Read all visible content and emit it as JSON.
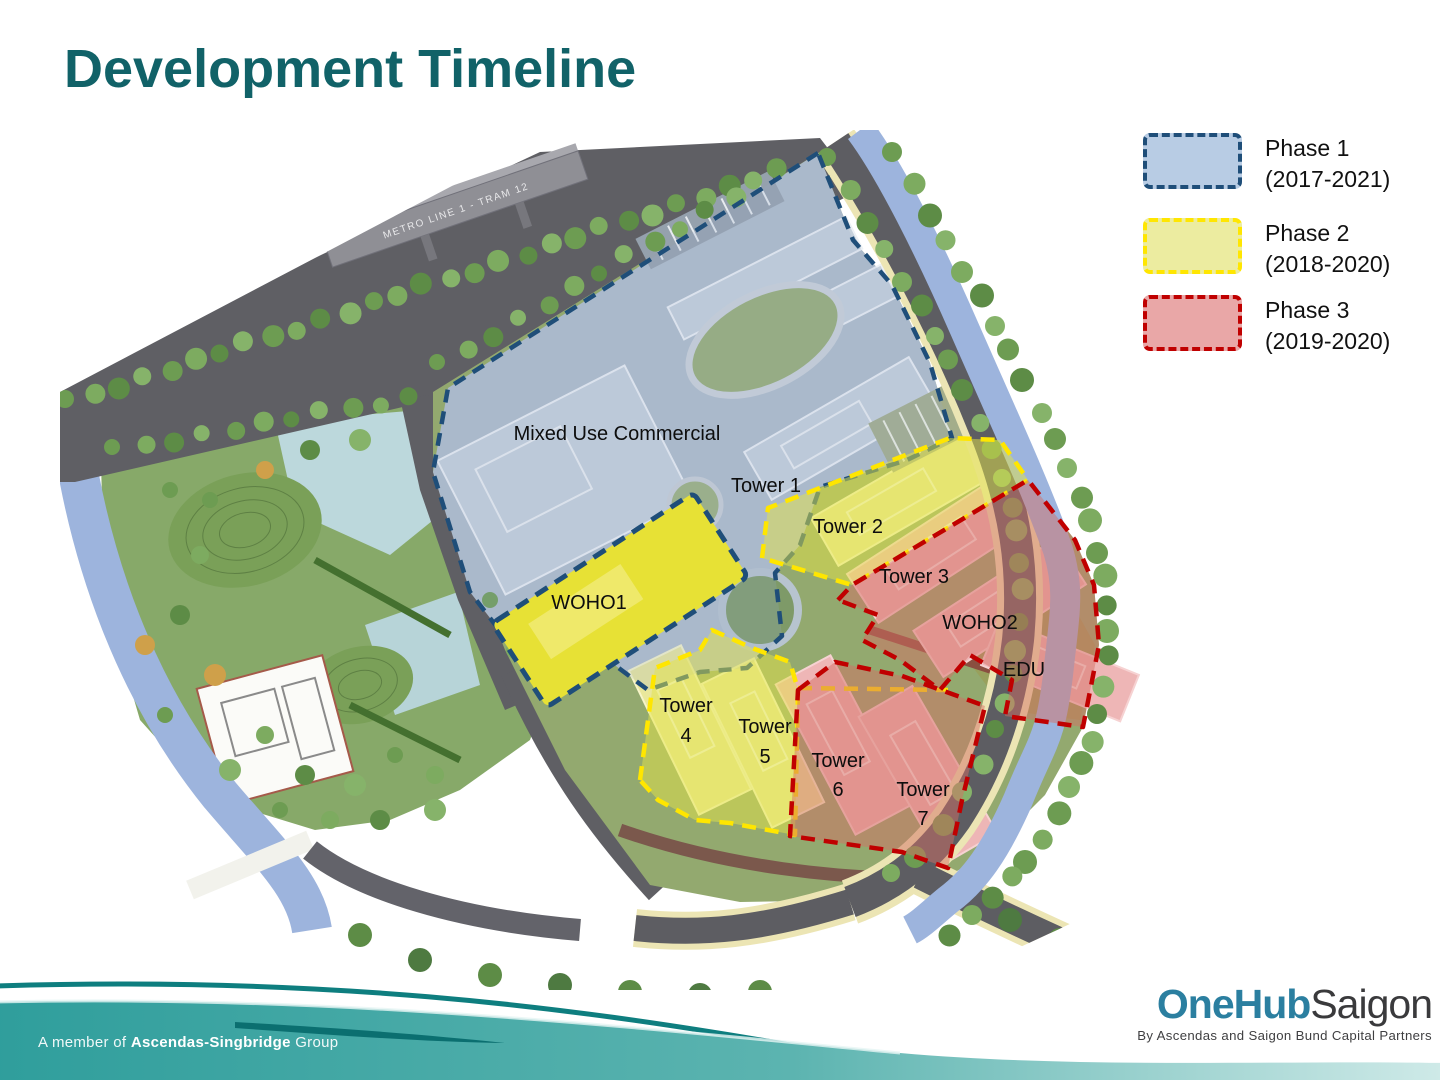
{
  "slide": {
    "title": "Development Timeline"
  },
  "legend": {
    "items": [
      {
        "name": "Phase 1",
        "years": "(2017-2021)"
      },
      {
        "name": "Phase 2",
        "years": "(2018-2020)"
      },
      {
        "name": "Phase 3",
        "years": "(2019-2020)"
      }
    ]
  },
  "map": {
    "labels": {
      "mixed_use": "Mixed Use Commercial",
      "tower1": "Tower 1",
      "tower2": "Tower 2",
      "tower3": "Tower 3",
      "woho2": "WOHO2",
      "edu": "EDU",
      "woho1": "WOHO1",
      "tower4_l1": "Tower",
      "tower4_l2": "4",
      "tower5_l1": "Tower",
      "tower5_l2": "5",
      "tower6_l1": "Tower",
      "tower6_l2": "6",
      "tower7_l1": "Tower",
      "tower7_l2": "7"
    },
    "metro_sign": "METRO LINE 1 - TRAM 12"
  },
  "footer": {
    "membership_prefix": "A member of",
    "membership_bold": "Ascendas-Singbridge",
    "membership_suffix": "Group",
    "logo_primary": "OneHub",
    "logo_secondary": "Saigon",
    "tagline": "By Ascendas and Saigon Bund Capital Partners"
  },
  "colors": {
    "title": "#116268",
    "phase1-border": "#1f4e79",
    "phase1-fill": "#b8cce4",
    "phase2-border": "#ffe600",
    "phase2-fill": "#ececa0",
    "phase3-border": "#c00000",
    "phase3-fill": "#e9a7a7",
    "teal-band": "#2f9e9c"
  }
}
